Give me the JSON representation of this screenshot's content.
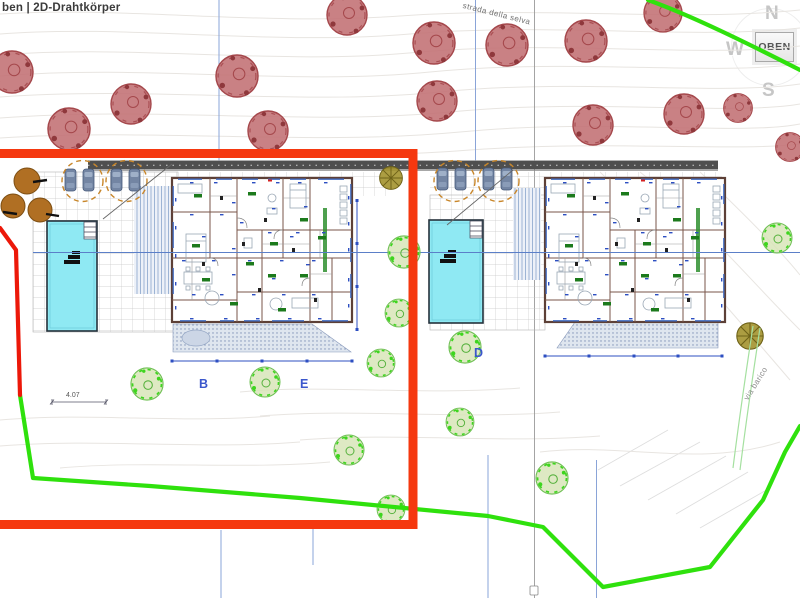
{
  "header": {
    "view_label": "ben | 2D-Drahtkörper"
  },
  "navigation_cube": {
    "letter_north": "N",
    "letter_west": "W",
    "letter_south": "S",
    "top_face_label": "OBEN"
  },
  "site_plan": {
    "street_label_top": "strada della selva",
    "street_label_right": "via barico",
    "unit_label_b": "B",
    "unit_label_e": "E",
    "unit_label_d": "D",
    "dimension_label": "4.07"
  },
  "colors": {
    "selection_red": "#f5380f",
    "boundary_green": "#2fe10d",
    "boundary_red": "#ec1809",
    "pool_cyan": "#8fe9f3",
    "tree_red_fill": "#c17073",
    "tree_red_stroke": "#a5484c",
    "tree_green_stroke": "#3ed51f",
    "tree_green_fill": "#d6e4b4",
    "tree_brown": "#b06f23",
    "road_gray": "#4f4f4f",
    "dimension_blue": "#2d4fc2",
    "unit_label_blue": "#3b57cc"
  }
}
